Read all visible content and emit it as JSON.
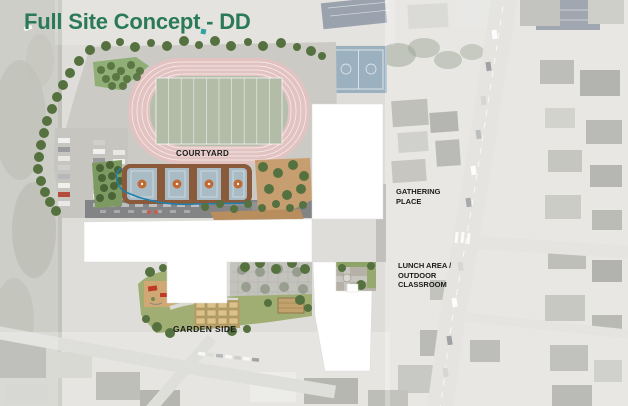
{
  "slide": {
    "title": "Full Site Concept - DD"
  },
  "plan_labels": {
    "courtyard": "COURTYARD",
    "gathering_place": "GATHERING\nPLACE",
    "lunch_area": "LUNCH AREA /\nOUTDOOR\nCLASSROOM",
    "garden_side": "GARDEN SIDE"
  },
  "colors": {
    "title_green": "#2a7a57",
    "label_black": "#1c1c1c",
    "track_pink": "#e2c3c1",
    "field_green": "#b6bfab",
    "court_blue": "#a9bcc6",
    "court_frame_brown": "#8a5a3b",
    "court_accent_orange": "#c06a35",
    "massing_white": "#ffffff",
    "lawn_green": "#a0ae74",
    "plaza_tan": "#c79e6f",
    "tree_green": "#55713f",
    "paving_gray": "#cbcac5",
    "water_feature_blue": "#1f7fae"
  }
}
